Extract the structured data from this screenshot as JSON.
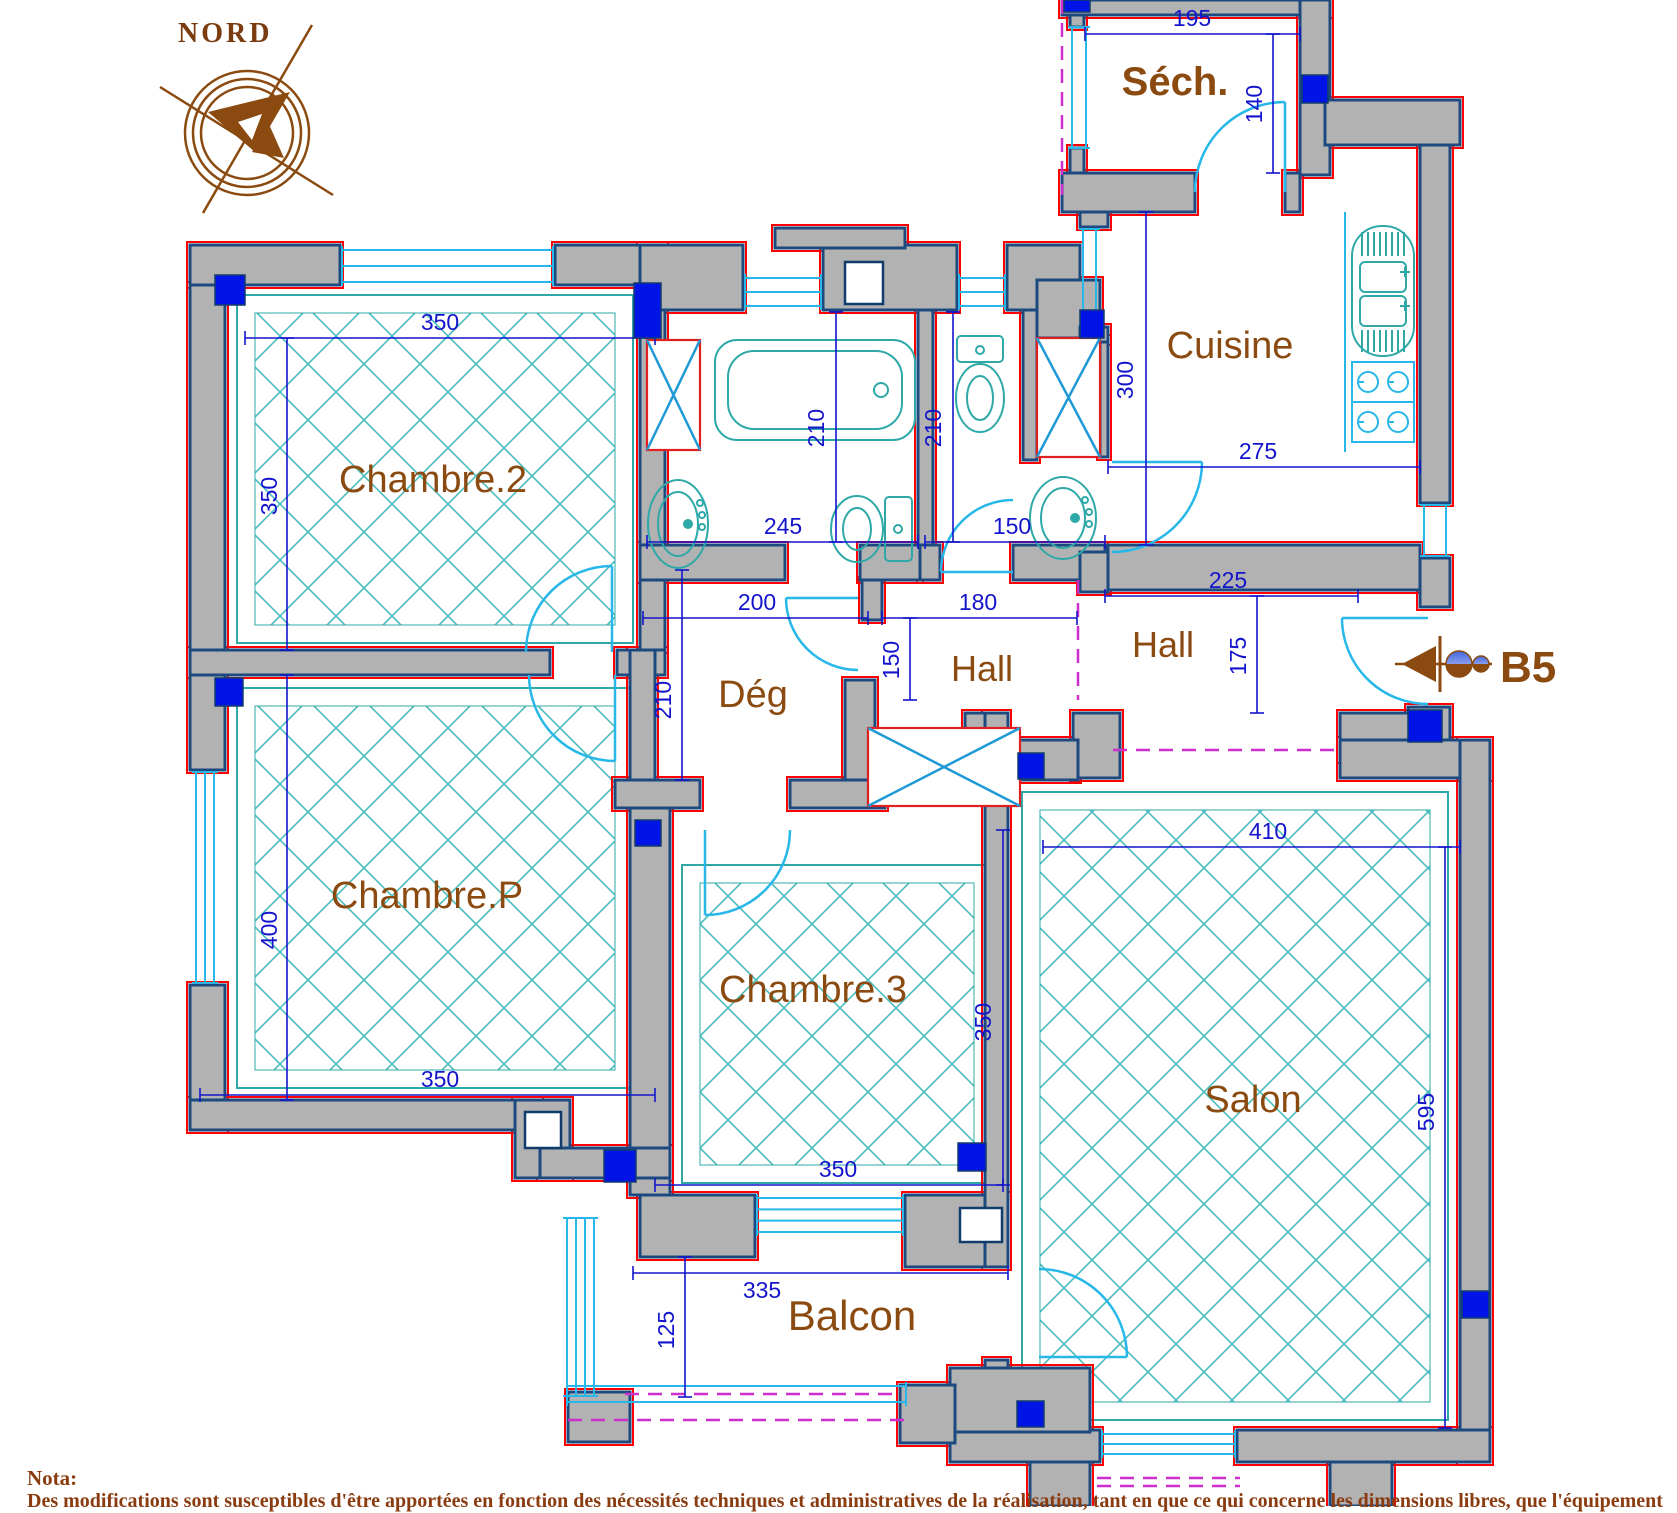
{
  "title_block": {
    "compass_label": "NORD",
    "entrance_label": "B5"
  },
  "nota": {
    "title": "Nota:",
    "body": "Des modifications sont susceptibles d'être apportées en fonction des nécessités techniques et  administratives de la réalisation, tant en que ce qui concerne les dimensions libres, que l'équipement"
  },
  "colors": {
    "wall_fill": "#b2b2b2",
    "wall_stroke": "#1c4a80",
    "red_outline": "#ff0000",
    "window_door_cyan": "#27b7e8",
    "fixture_teal": "#2fa8a8",
    "dimension_blue": "#1414cc",
    "boundary_magenta": "#cc2fcc",
    "label_brown": "#8a4a10",
    "column_blue": "#0014e6"
  },
  "plan": {
    "room_labels": [
      {
        "name": "Séch.",
        "x": 1175,
        "y": 95,
        "size": 40,
        "bold": true
      },
      {
        "name": "Cuisine",
        "x": 1230,
        "y": 358,
        "size": 38,
        "bold": false
      },
      {
        "name": "Chambre.2",
        "x": 433,
        "y": 492,
        "size": 38,
        "bold": false
      },
      {
        "name": "Chambre.P",
        "x": 427,
        "y": 908,
        "size": 38,
        "bold": false
      },
      {
        "name": "Chambre.3",
        "x": 813,
        "y": 1002,
        "size": 38,
        "bold": false
      },
      {
        "name": "Salon",
        "x": 1253,
        "y": 1112,
        "size": 38,
        "bold": false
      },
      {
        "name": "Balcon",
        "x": 852,
        "y": 1330,
        "size": 42,
        "bold": false
      },
      {
        "name": "Hall",
        "x": 982,
        "y": 681,
        "size": 36,
        "bold": false
      },
      {
        "name": "Hall",
        "x": 1163,
        "y": 657,
        "size": 36,
        "bold": false
      },
      {
        "name": "Dég",
        "x": 753,
        "y": 707,
        "size": 38,
        "bold": false
      }
    ],
    "dims": [
      {
        "label": "195",
        "x1": 1085,
        "y1": 34,
        "x2": 1300,
        "y2": 34,
        "v": false,
        "lx": 1192,
        "ly": 26
      },
      {
        "label": "140",
        "x1": 1273,
        "y1": 34,
        "x2": 1273,
        "y2": 173,
        "v": true,
        "lx": 1262,
        "ly": 104
      },
      {
        "label": "300",
        "x1": 1146,
        "y1": 212,
        "x2": 1146,
        "y2": 545,
        "v": true,
        "lx": 1133,
        "ly": 380
      },
      {
        "label": "275",
        "x1": 1108,
        "y1": 467,
        "x2": 1420,
        "y2": 467,
        "v": false,
        "lx": 1258,
        "ly": 459
      },
      {
        "label": "225",
        "x1": 1105,
        "y1": 596,
        "x2": 1358,
        "y2": 596,
        "v": false,
        "lx": 1228,
        "ly": 588
      },
      {
        "label": "175",
        "x1": 1257,
        "y1": 596,
        "x2": 1257,
        "y2": 713,
        "v": true,
        "lx": 1246,
        "ly": 656
      },
      {
        "label": "150",
        "x1": 925,
        "y1": 542,
        "x2": 1105,
        "y2": 542,
        "v": false,
        "lx": 1012,
        "ly": 534
      },
      {
        "label": "245",
        "x1": 647,
        "y1": 542,
        "x2": 918,
        "y2": 542,
        "v": false,
        "lx": 783,
        "ly": 534
      },
      {
        "label": "210",
        "x1": 836,
        "y1": 312,
        "x2": 836,
        "y2": 542,
        "v": true,
        "lx": 824,
        "ly": 428
      },
      {
        "label": "210",
        "x1": 953,
        "y1": 312,
        "x2": 953,
        "y2": 542,
        "v": true,
        "lx": 941,
        "ly": 428
      },
      {
        "label": "350",
        "x1": 245,
        "y1": 338,
        "x2": 655,
        "y2": 338,
        "v": false,
        "lx": 440,
        "ly": 330
      },
      {
        "label": "350",
        "x1": 287,
        "y1": 338,
        "x2": 287,
        "y2": 650,
        "v": true,
        "lx": 277,
        "ly": 496
      },
      {
        "label": "400",
        "x1": 287,
        "y1": 675,
        "x2": 287,
        "y2": 1100,
        "v": true,
        "lx": 277,
        "ly": 930
      },
      {
        "label": "350",
        "x1": 200,
        "y1": 1095,
        "x2": 655,
        "y2": 1095,
        "v": false,
        "lx": 440,
        "ly": 1087
      },
      {
        "label": "200",
        "x1": 643,
        "y1": 618,
        "x2": 868,
        "y2": 618,
        "v": false,
        "lx": 757,
        "ly": 610
      },
      {
        "label": "210",
        "x1": 682,
        "y1": 570,
        "x2": 682,
        "y2": 780,
        "v": true,
        "lx": 671,
        "ly": 700
      },
      {
        "label": "180",
        "x1": 882,
        "y1": 618,
        "x2": 1077,
        "y2": 618,
        "v": false,
        "lx": 978,
        "ly": 610
      },
      {
        "label": "150",
        "x1": 910,
        "y1": 618,
        "x2": 910,
        "y2": 700,
        "v": true,
        "lx": 899,
        "ly": 660
      },
      {
        "label": "410",
        "x1": 1043,
        "y1": 847,
        "x2": 1460,
        "y2": 847,
        "v": false,
        "lx": 1268,
        "ly": 839
      },
      {
        "label": "595",
        "x1": 1445,
        "y1": 847,
        "x2": 1445,
        "y2": 1428,
        "v": true,
        "lx": 1434,
        "ly": 1112
      },
      {
        "label": "350",
        "x1": 1003,
        "y1": 830,
        "x2": 1003,
        "y2": 1185,
        "v": true,
        "lx": 991,
        "ly": 1022
      },
      {
        "label": "350",
        "x1": 655,
        "y1": 1185,
        "x2": 1003,
        "y2": 1185,
        "v": false,
        "lx": 838,
        "ly": 1177
      },
      {
        "label": "335",
        "x1": 633,
        "y1": 1273,
        "x2": 1008,
        "y2": 1273,
        "v": false,
        "lx": 762,
        "ly": 1298
      },
      {
        "label": "125",
        "x1": 685,
        "y1": 1257,
        "x2": 685,
        "y2": 1397,
        "v": true,
        "lx": 674,
        "ly": 1330
      }
    ],
    "walls": [
      [
        190,
        245,
        150,
        40
      ],
      [
        555,
        245,
        110,
        40
      ],
      [
        190,
        285,
        35,
        485
      ],
      [
        190,
        985,
        35,
        145
      ],
      [
        190,
        650,
        360,
        25
      ],
      [
        617,
        650,
        48,
        25
      ],
      [
        640,
        245,
        25,
        405
      ],
      [
        630,
        650,
        25,
        155
      ],
      [
        630,
        805,
        40,
        390
      ],
      [
        190,
        1100,
        350,
        30
      ],
      [
        515,
        1100,
        55,
        78
      ],
      [
        540,
        1148,
        130,
        30
      ],
      [
        640,
        1195,
        115,
        62
      ],
      [
        905,
        1195,
        103,
        72
      ],
      [
        615,
        780,
        85,
        28
      ],
      [
        790,
        780,
        95,
        28
      ],
      [
        845,
        680,
        30,
        100
      ],
      [
        640,
        545,
        145,
        35
      ],
      [
        860,
        545,
        60,
        35
      ],
      [
        920,
        545,
        20,
        35
      ],
      [
        1013,
        545,
        92,
        35
      ],
      [
        640,
        245,
        103,
        65
      ],
      [
        823,
        245,
        134,
        65
      ],
      [
        1007,
        245,
        73,
        65
      ],
      [
        775,
        228,
        130,
        20
      ],
      [
        918,
        310,
        15,
        235
      ],
      [
        1023,
        310,
        14,
        150
      ],
      [
        1037,
        280,
        63,
        58
      ],
      [
        1100,
        338,
        8,
        119
      ],
      [
        1080,
        195,
        28,
        32
      ],
      [
        1080,
        327,
        28,
        15
      ],
      [
        1080,
        552,
        28,
        40
      ],
      [
        1108,
        545,
        312,
        45
      ],
      [
        1062,
        0,
        268,
        15
      ],
      [
        1070,
        15,
        14,
        12
      ],
      [
        1070,
        148,
        14,
        27
      ],
      [
        1300,
        0,
        30,
        175
      ],
      [
        1062,
        173,
        133,
        39
      ],
      [
        1285,
        173,
        15,
        39
      ],
      [
        1325,
        100,
        135,
        45
      ],
      [
        1420,
        145,
        30,
        358
      ],
      [
        1420,
        558,
        30,
        49
      ],
      [
        1408,
        707,
        42,
        53
      ],
      [
        1340,
        713,
        80,
        47
      ],
      [
        1073,
        713,
        47,
        65
      ],
      [
        965,
        713,
        43,
        65
      ],
      [
        1018,
        740,
        60,
        40
      ],
      [
        1340,
        740,
        150,
        38
      ],
      [
        1460,
        740,
        30,
        722
      ],
      [
        985,
        713,
        23,
        554
      ],
      [
        985,
        1360,
        23,
        72
      ],
      [
        950,
        1430,
        150,
        32
      ],
      [
        1237,
        1430,
        253,
        32
      ],
      [
        1030,
        1462,
        60,
        44
      ],
      [
        1330,
        1462,
        62,
        44
      ],
      [
        950,
        1368,
        140,
        64
      ],
      [
        568,
        1392,
        62,
        50
      ],
      [
        900,
        1385,
        55,
        58
      ],
      [
        862,
        580,
        20,
        40
      ]
    ],
    "columns": [
      [
        215,
        275,
        30,
        30
      ],
      [
        634,
        283,
        27,
        55
      ],
      [
        1080,
        310,
        24,
        28
      ],
      [
        1302,
        75,
        26,
        28
      ],
      [
        215,
        678,
        28,
        28
      ],
      [
        635,
        820,
        26,
        26
      ],
      [
        1018,
        753,
        26,
        26
      ],
      [
        1408,
        710,
        34,
        32
      ],
      [
        1462,
        1291,
        27,
        27
      ],
      [
        1017,
        1401,
        27,
        26
      ],
      [
        604,
        1150,
        32,
        32
      ],
      [
        958,
        1143,
        28,
        28
      ],
      [
        1064,
        0,
        26,
        12
      ]
    ],
    "windows": [
      [
        342,
        250,
        553,
        282,
        3
      ],
      [
        196,
        772,
        214,
        983,
        3
      ],
      [
        745,
        278,
        821,
        306,
        3
      ],
      [
        959,
        278,
        1005,
        306,
        3
      ],
      [
        1072,
        27,
        1086,
        148,
        2
      ],
      [
        1083,
        229,
        1096,
        325,
        2
      ],
      [
        1424,
        505,
        1446,
        556,
        2
      ],
      [
        757,
        1198,
        903,
        1232,
        4
      ],
      [
        1102,
        1434,
        1235,
        1454,
        3
      ],
      [
        567,
        1218,
        594,
        1396,
        4
      ],
      [
        567,
        1386,
        906,
        1402,
        2
      ]
    ]
  }
}
